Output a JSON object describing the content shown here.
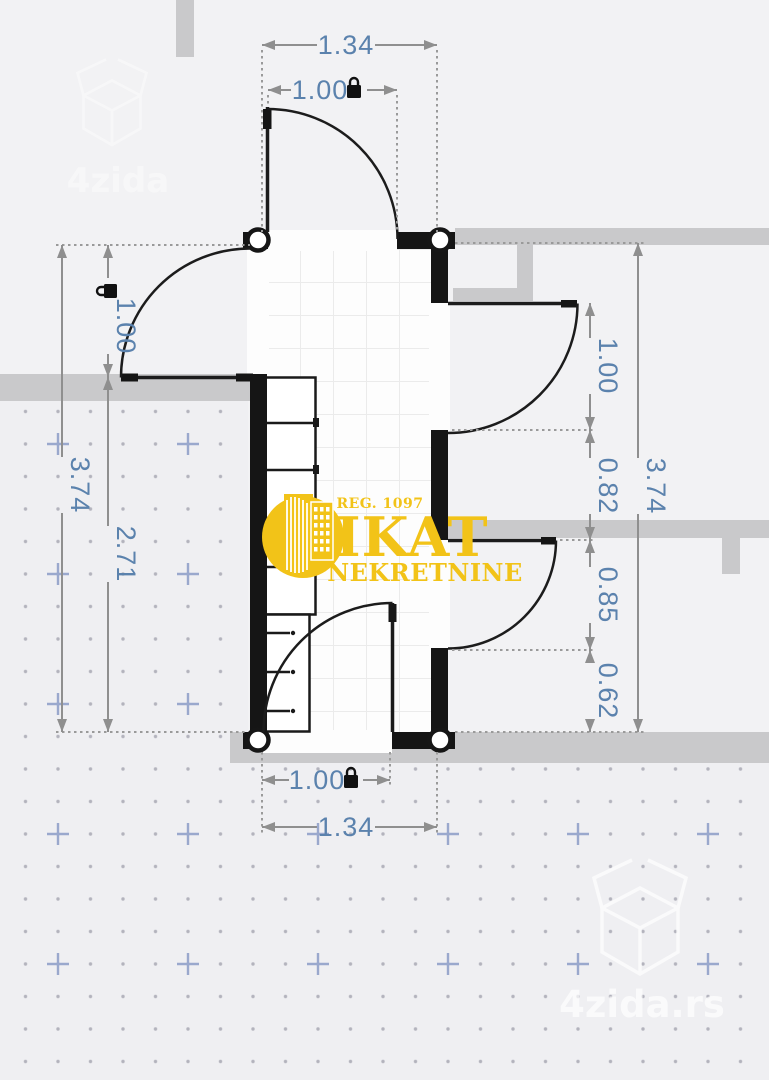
{
  "plan": {
    "type": "floor-plan",
    "dimensions": {
      "top_total": "1.34",
      "top_door": "1.00",
      "left_total": "3.74",
      "left_door": "1.00",
      "left_wall_lower": "2.71",
      "right_total": "3.74",
      "right_door_upper": "1.00",
      "right_wall_upper": "0.82",
      "right_door_lower": "0.85",
      "right_wall_lower": "0.62",
      "bottom_door": "1.00",
      "bottom_total": "1.34"
    }
  },
  "logo": {
    "registration": "REG. 1097",
    "brand": "IKAT",
    "subtitle": "NEKRETNINE"
  },
  "watermark": {
    "top_left": "4zida",
    "bottom_right": "4zida.rs"
  },
  "colors": {
    "background": "#f2f2f4",
    "dotted_background": "#efeff2",
    "wall_black": "#151515",
    "wall_gray": "#c9c9cb",
    "floor": "#fdfdfd",
    "tile_line": "#ebebeb",
    "dimension_line": "#8f8f8f",
    "dimension_text": "#5b82ad",
    "logo_gold": "#f2c318",
    "grid_dot": "#b3b3bd",
    "grid_cross": "#9aa8cd"
  }
}
